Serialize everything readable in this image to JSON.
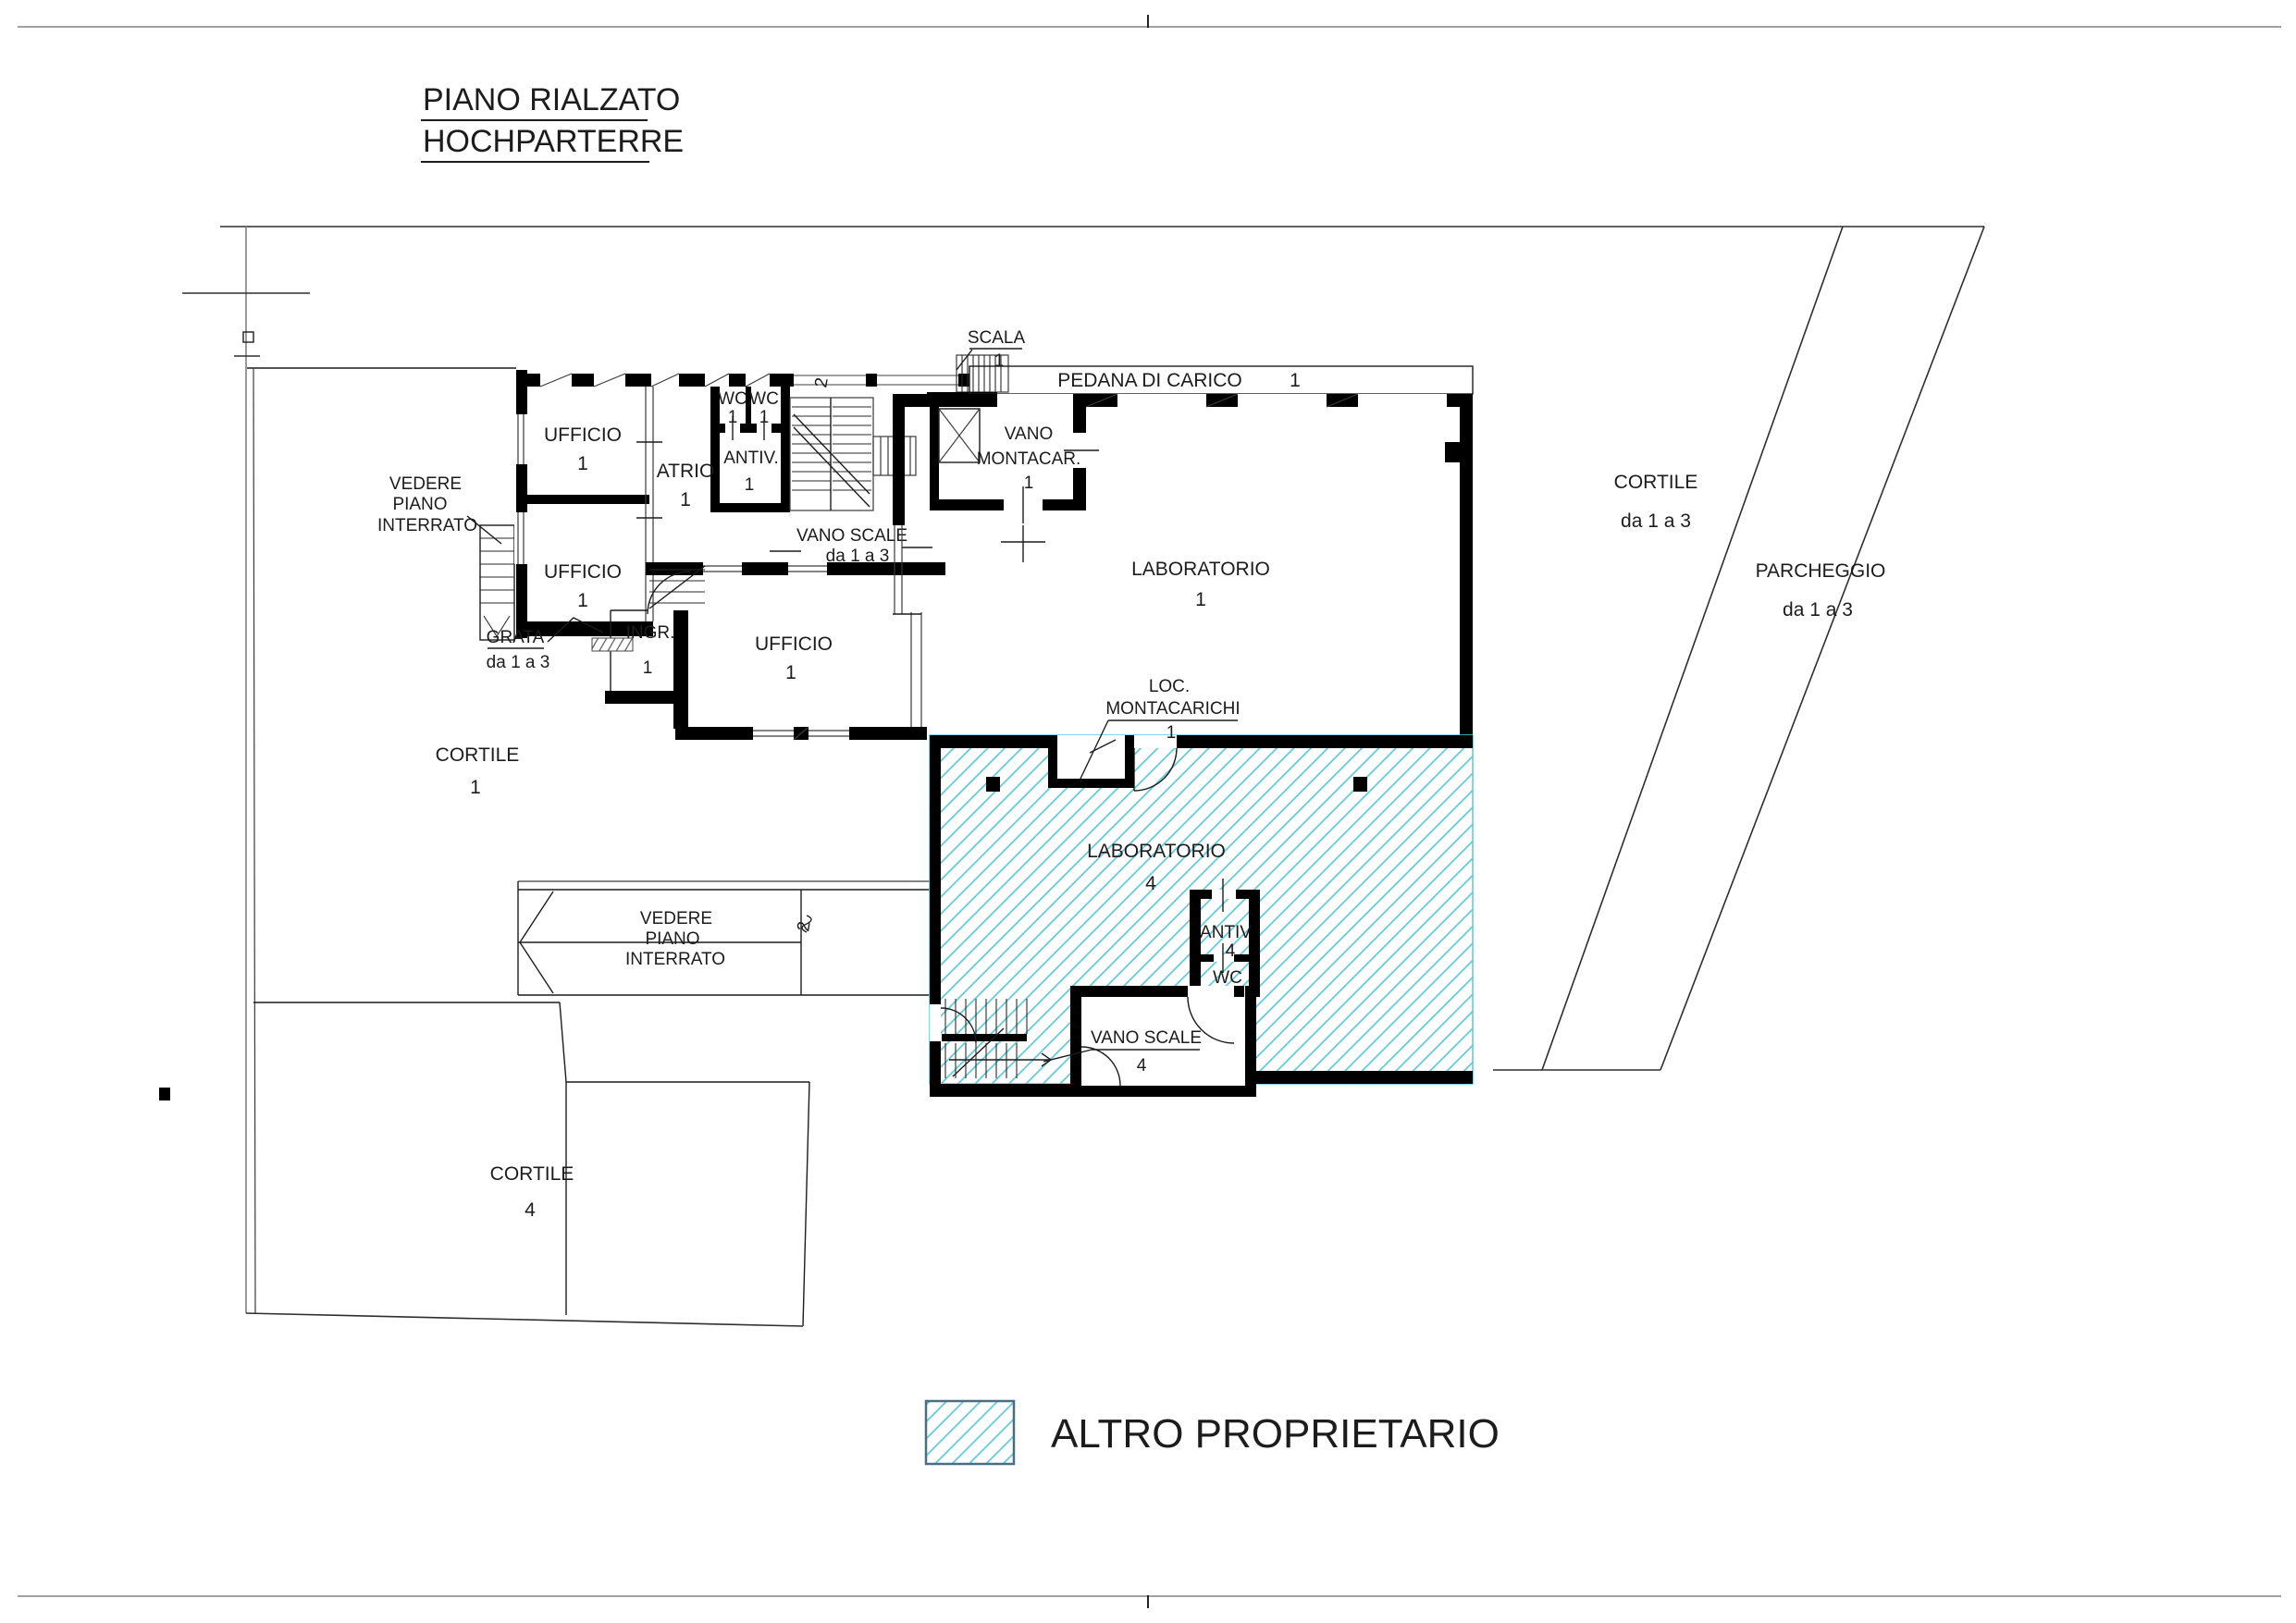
{
  "title": {
    "line1": "PIANO RIALZATO",
    "line2": "HOCHPARTERRE"
  },
  "colors": {
    "hatch": "#5BC8D8",
    "legend_text": "#29ABE2",
    "wall": "#000000"
  },
  "legend": {
    "label": "ALTRO PROPRIETARIO"
  },
  "labels": {
    "ufficio_a": "UFFICIO",
    "ufficio_a_n": "1",
    "ufficio_b": "UFFICIO",
    "ufficio_b_n": "1",
    "ufficio_c": "UFFICIO",
    "ufficio_c_n": "1",
    "atrio": "ATRIO",
    "atrio_n": "1",
    "wc_a": "WC",
    "wc_a_n": "1",
    "wc_b": "WC",
    "wc_b_n": "1",
    "antiv": "ANTIV.",
    "antiv_n": "1",
    "scala": "SCALA",
    "scala_n": "1",
    "vano_scale_13": "VANO SCALE",
    "vano_scale_13_n": "da 1 a 3",
    "vedere_l1": "VEDERE",
    "vedere_l2": "PIANO",
    "vedere_l3": "INTERRATO",
    "vedere_c1": "VEDERE",
    "vedere_c2": "PIANO",
    "vedere_c3": "INTERRATO",
    "grata": "GRATA",
    "grata_n": "da 1 a 3",
    "ingr": "INGR.",
    "ingr_n": "1",
    "pedana": "PEDANA DI CARICO",
    "pedana_n": "1",
    "vano_mont_1": "VANO",
    "vano_mont_2": "MONTACAR.",
    "vano_mont_n": "1",
    "lab1": "LABORATORIO",
    "lab1_n": "1",
    "loc_1": "LOC.",
    "loc_2": "MONTACARICHI",
    "loc_n": "1",
    "cortile13": "CORTILE",
    "cortile13_n": "da 1 a 3",
    "parcheggio": "PARCHEGGIO",
    "parcheggio_n": "da 1 a 3",
    "cortile1": "CORTILE",
    "cortile1_n": "1",
    "lab4": "LABORATORIO",
    "lab4_n": "4",
    "antiv4": "ANTIV",
    "antiv4_n": "4",
    "wc4": "WC",
    "wc4_n": "4",
    "vano_scale4": "VANO SCALE",
    "vano_scale4_n": "4",
    "cortile4": "CORTILE",
    "cortile4_n": "4",
    "mark_a": "2",
    "mark_b": "2"
  }
}
